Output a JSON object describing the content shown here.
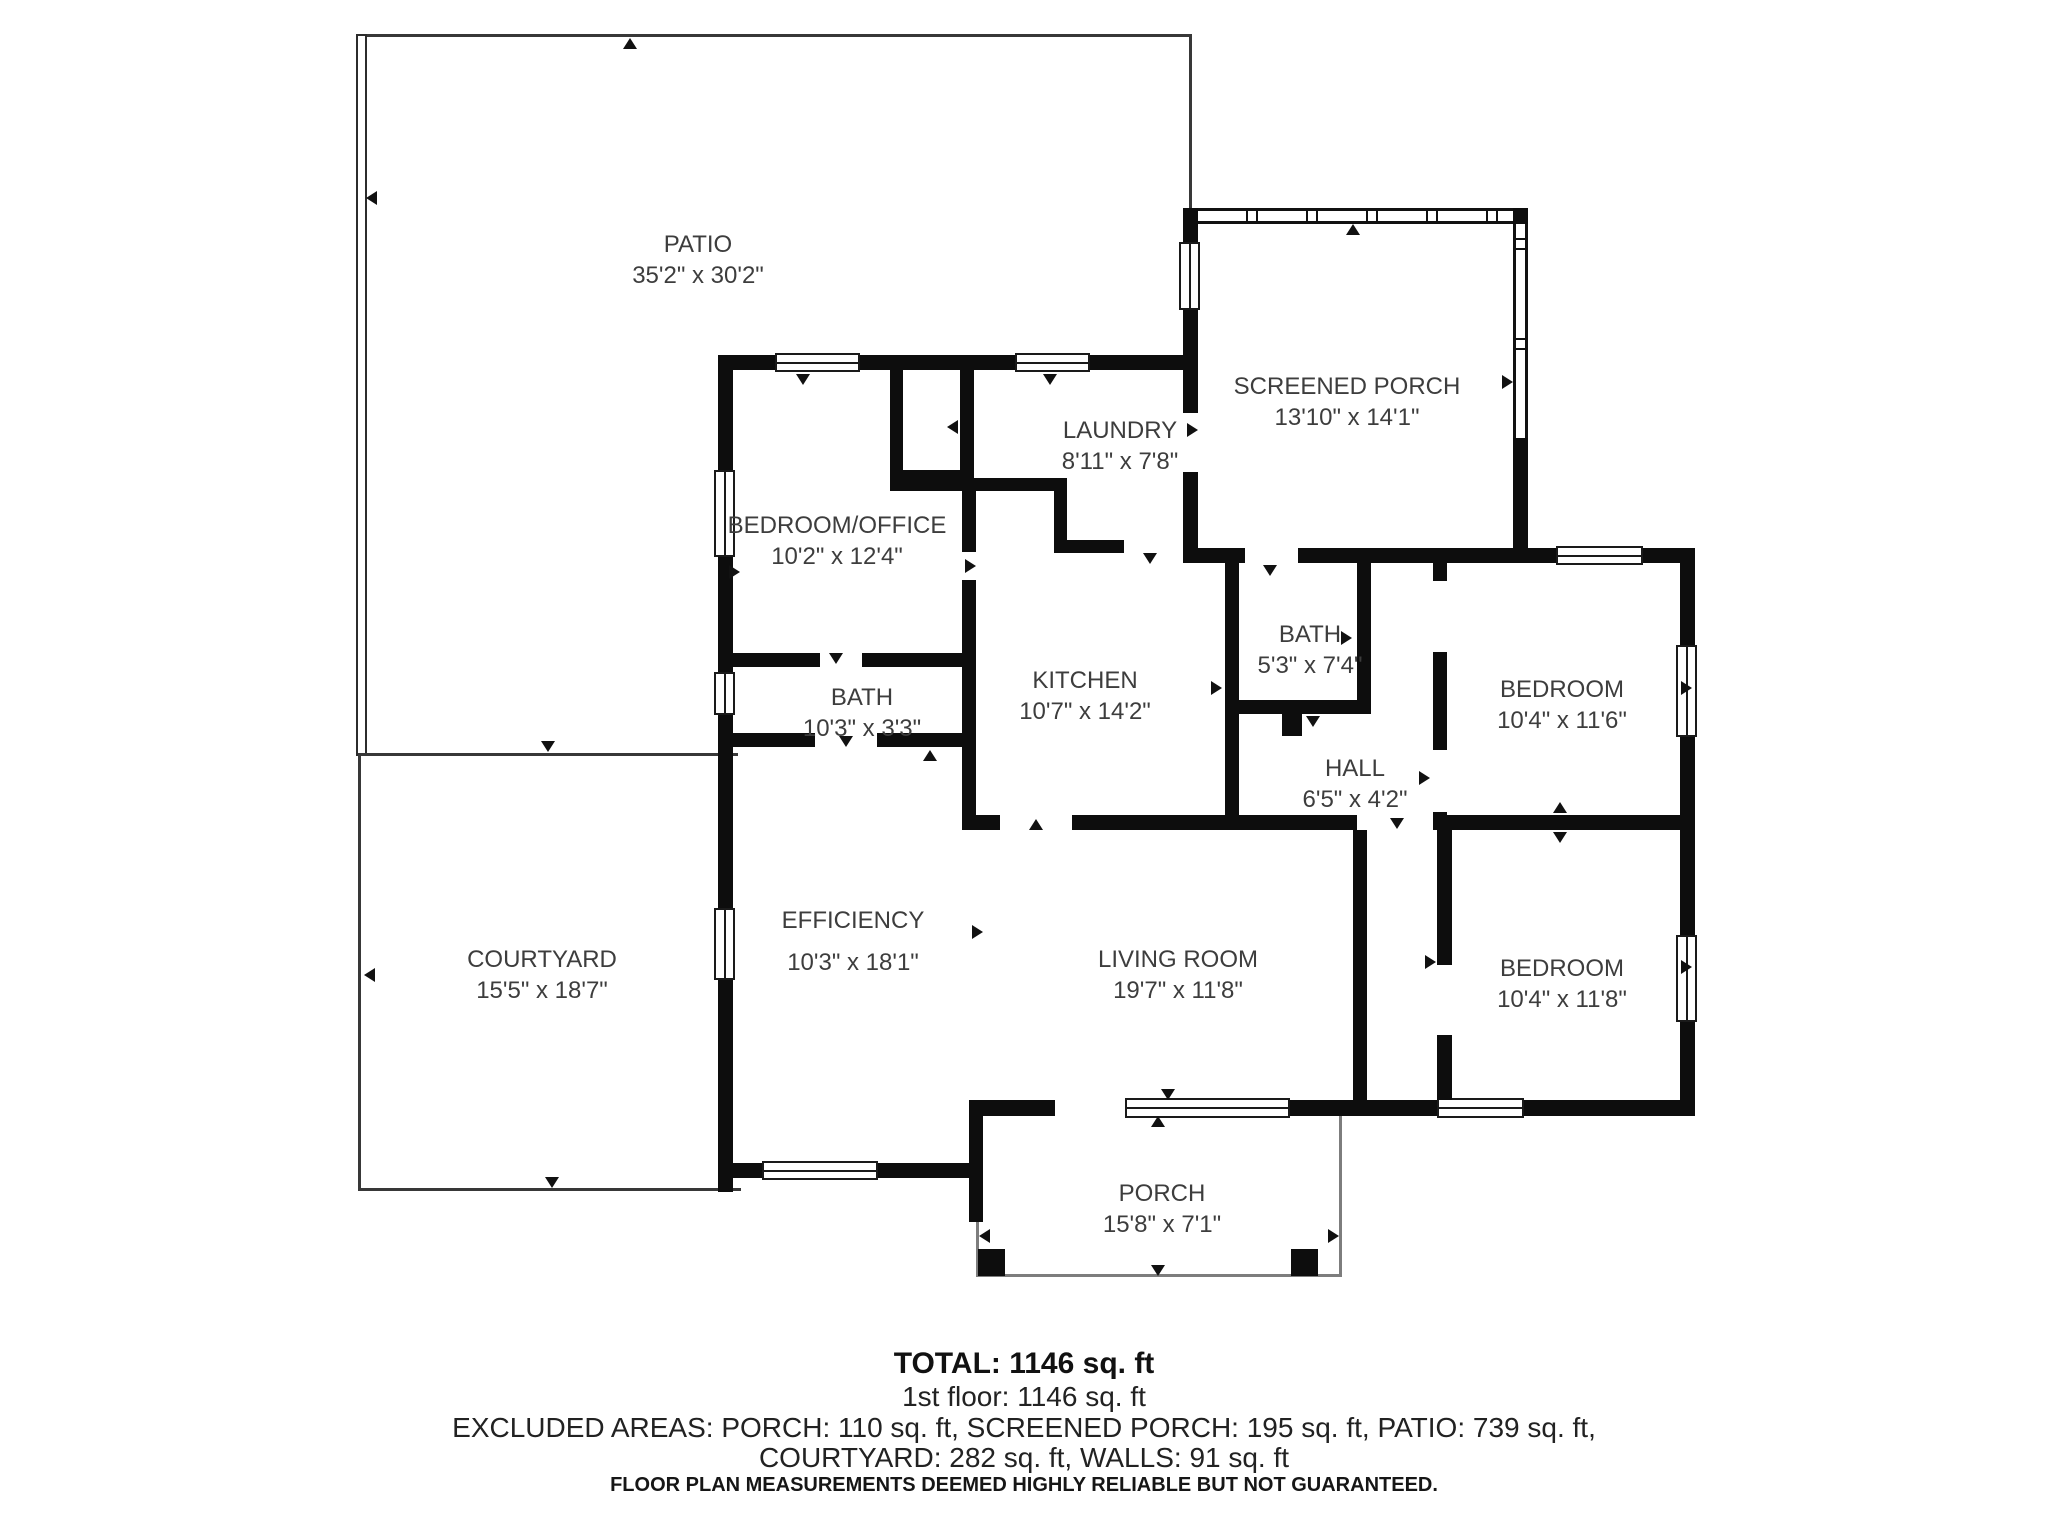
{
  "plan": {
    "rooms": [
      {
        "id": "patio",
        "name": "PATIO",
        "dims": "35'2\" x 30'2\""
      },
      {
        "id": "screened_porch",
        "name": "SCREENED PORCH",
        "dims": "13'10\" x 14'1\""
      },
      {
        "id": "laundry",
        "name": "LAUNDRY",
        "dims": "8'11\" x 7'8\""
      },
      {
        "id": "bedroom_office",
        "name": "BEDROOM/OFFICE",
        "dims": "10'2\" x 12'4\""
      },
      {
        "id": "bath_upper",
        "name": "BATH",
        "dims": "5'3\" x 7'4\""
      },
      {
        "id": "kitchen",
        "name": "KITCHEN",
        "dims": "10'7\" x 14'2\""
      },
      {
        "id": "bedroom_upper",
        "name": "BEDROOM",
        "dims": "10'4\" x 11'6\""
      },
      {
        "id": "bath_small",
        "name": "BATH",
        "dims": "10'3\" x 3'3\""
      },
      {
        "id": "hall",
        "name": "HALL",
        "dims": "6'5\" x 4'2\""
      },
      {
        "id": "courtyard",
        "name": "COURTYARD",
        "dims": "15'5\" x 18'7\""
      },
      {
        "id": "efficiency",
        "name": "EFFICIENCY",
        "dims": "10'3\" x 18'1\""
      },
      {
        "id": "living_room",
        "name": "LIVING ROOM",
        "dims": "19'7\" x 11'8\""
      },
      {
        "id": "bedroom_lower",
        "name": "BEDROOM",
        "dims": "10'4\" x 11'8\""
      },
      {
        "id": "porch",
        "name": "PORCH",
        "dims": "15'8\" x 7'1\""
      }
    ]
  },
  "footer": {
    "total": "TOTAL: 1146 sq. ft",
    "first_floor": "1st floor: 1146 sq. ft",
    "excluded_line1": "EXCLUDED AREAS: PORCH: 110 sq. ft, SCREENED PORCH: 195 sq. ft, PATIO: 739 sq. ft,",
    "excluded_line2": "COURTYARD: 282 sq. ft, WALLS: 91 sq. ft",
    "disclaimer": "FLOOR PLAN MEASUREMENTS DEEMED HIGHLY RELIABLE BUT NOT GUARANTEED."
  },
  "colors": {
    "wall": "#0d0d0d",
    "label_text": "#3d3d3d",
    "porch_outline": "#7d7d7d",
    "background": "#ffffff"
  }
}
